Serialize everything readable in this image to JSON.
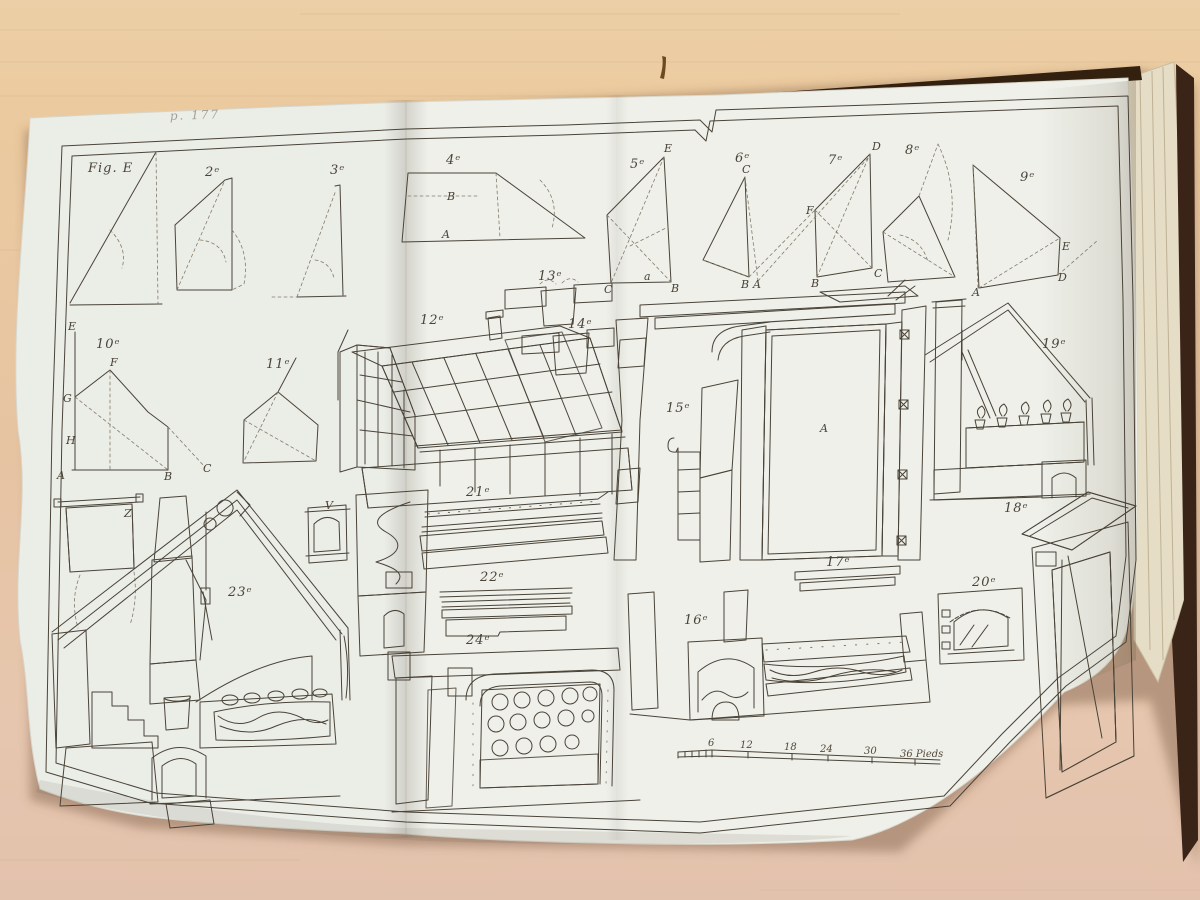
{
  "plate": {
    "handwritten_note": "p. 177",
    "figures": {
      "e": "Fig. E",
      "n2": "2ᵉ",
      "n3": "3ᵉ",
      "n4": "4ᵉ",
      "n5": "5ᵉ",
      "n6": "6ᵉ",
      "n7": "7ᵉ",
      "n8": "8ᵉ",
      "n9": "9ᵉ",
      "n10": "10ᵉ",
      "n11": "11ᵉ",
      "n12": "12ᵉ",
      "n13": "13ᵉ",
      "n14": "14ᵉ",
      "n15": "15ᵉ",
      "n16": "16ᵉ",
      "n17": "17ᵉ",
      "n18": "18ᵉ",
      "n19": "19ᵉ",
      "n20": "20ᵉ",
      "n21": "21ᵉ",
      "n22": "22ᵉ",
      "n23": "23ᵉ",
      "n24": "24ᵉ"
    },
    "letters": {
      "a15": "A",
      "l4B": "B",
      "l4A": "A",
      "l5E": "E",
      "l5C": "C",
      "l5B": "B",
      "l5a": "a",
      "l6C": "C",
      "l6B": "B",
      "l6A": "A",
      "l7D": "D",
      "l7F": "F",
      "l7B": "B",
      "l7C": "C",
      "l9E": "E",
      "l9D": "D",
      "l9A": "A",
      "l10E": "E",
      "l10F": "F",
      "l10G": "G",
      "l10H": "H",
      "l10A": "A",
      "l10B": "B",
      "l10C": "C",
      "l23Z": "Z",
      "l23V": "V"
    },
    "scale": {
      "t6": "6",
      "t12": "12",
      "t18": "18",
      "t24": "24",
      "t30": "30",
      "end": "36 Pieds"
    }
  }
}
